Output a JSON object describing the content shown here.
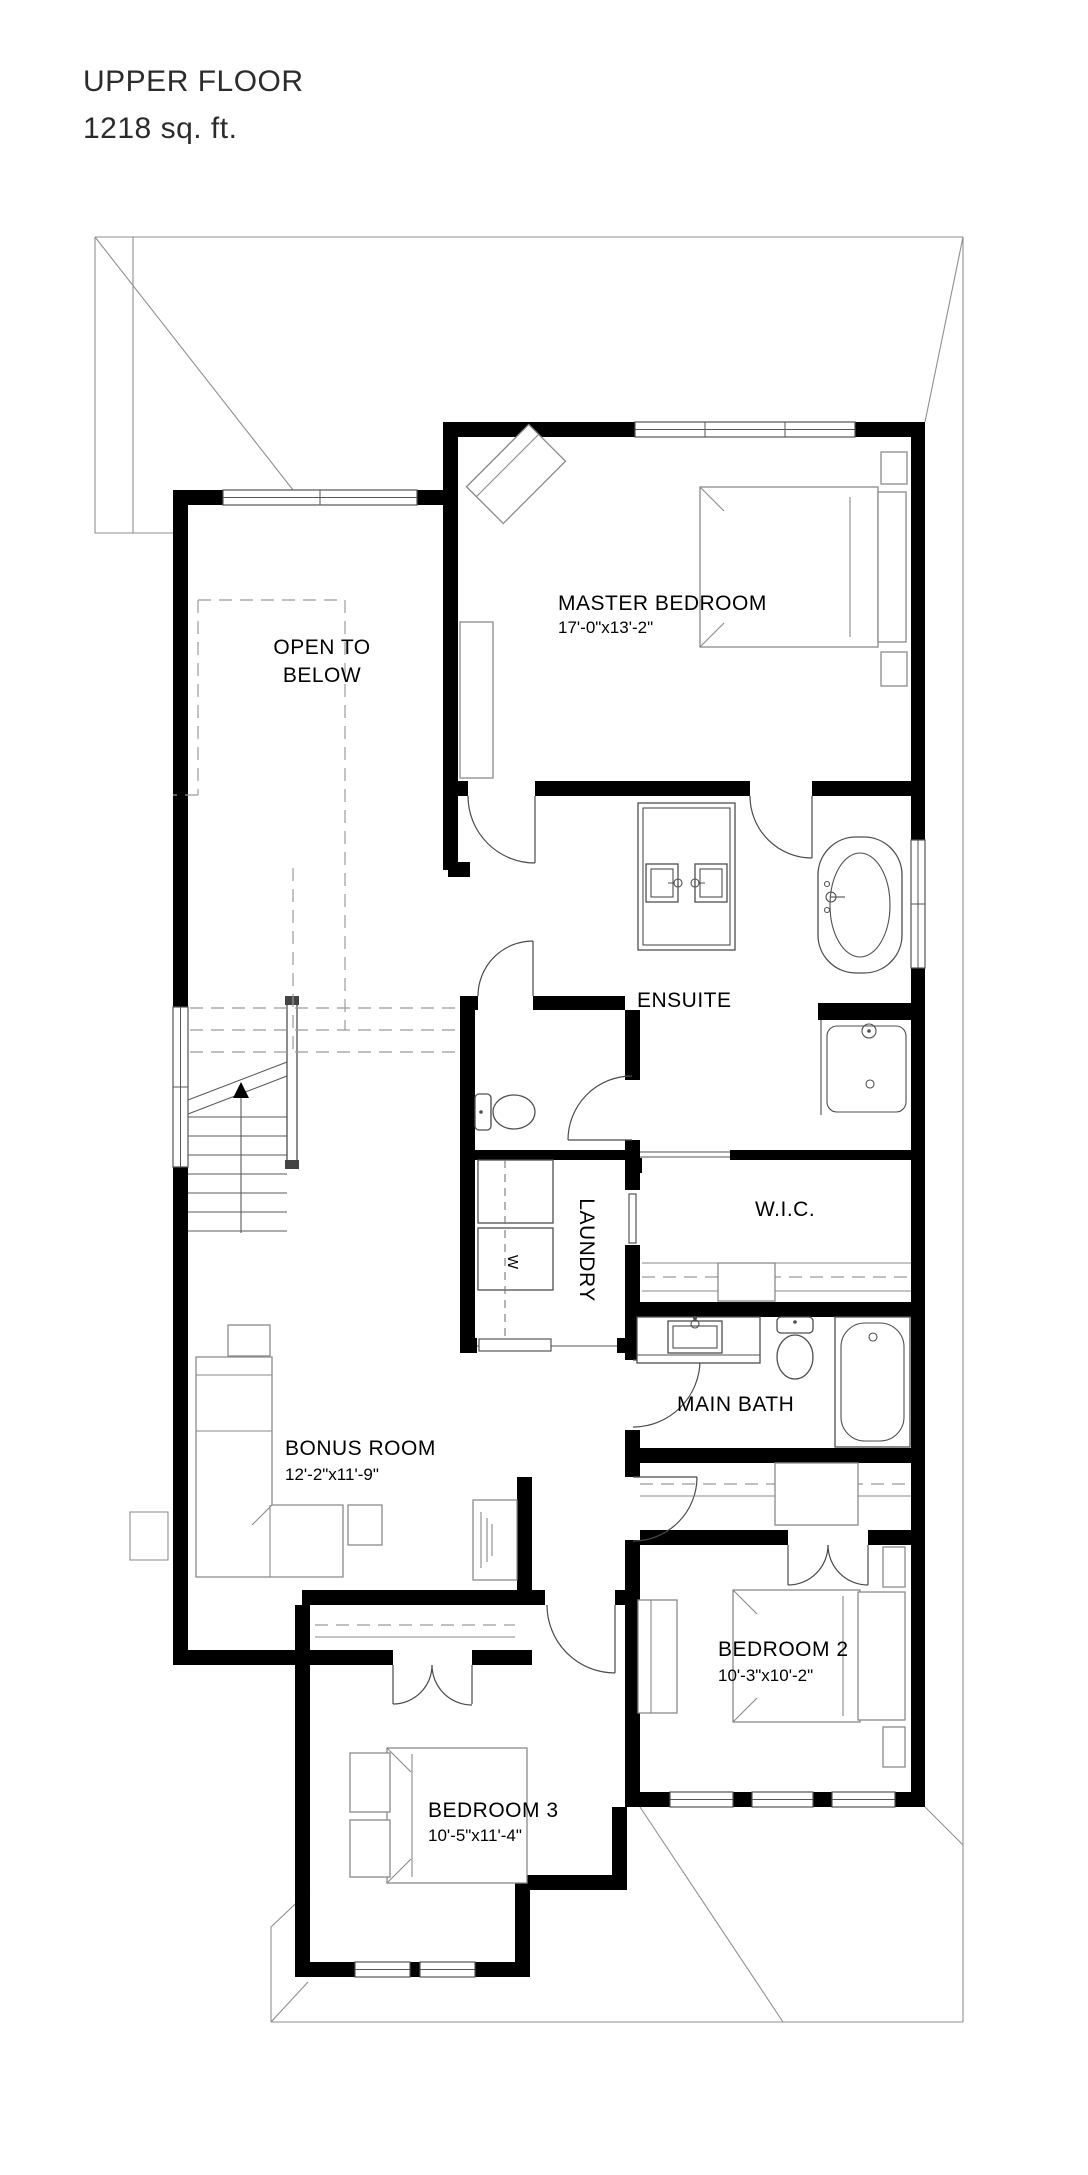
{
  "title": {
    "line1": "UPPER FLOOR",
    "line2": "1218 sq. ft."
  },
  "rooms": {
    "master_bedroom": {
      "name": "MASTER BEDROOM",
      "dims": "17'-0\"x13'-2\""
    },
    "open_to_below": {
      "name_line1": "OPEN TO",
      "name_line2": "BELOW"
    },
    "ensuite": {
      "name": "ENSUITE"
    },
    "laundry": {
      "name": "LAUNDRY"
    },
    "wic": {
      "name": "W.I.C."
    },
    "main_bath": {
      "name": "MAIN BATH"
    },
    "bonus_room": {
      "name": "BONUS ROOM",
      "dims": "12'-2\"x11'-9\""
    },
    "bedroom_2": {
      "name": "BEDROOM 2",
      "dims": "10'-3\"x10'-2\""
    },
    "bedroom_3": {
      "name": "BEDROOM 3",
      "dims": "10'-5\"x11'-4\""
    }
  },
  "appliances": {
    "washer_label": "W"
  },
  "colors": {
    "wall": "#000000",
    "line": "#4f4f4f",
    "roof": "#8f8f8f",
    "text": "#000000"
  }
}
